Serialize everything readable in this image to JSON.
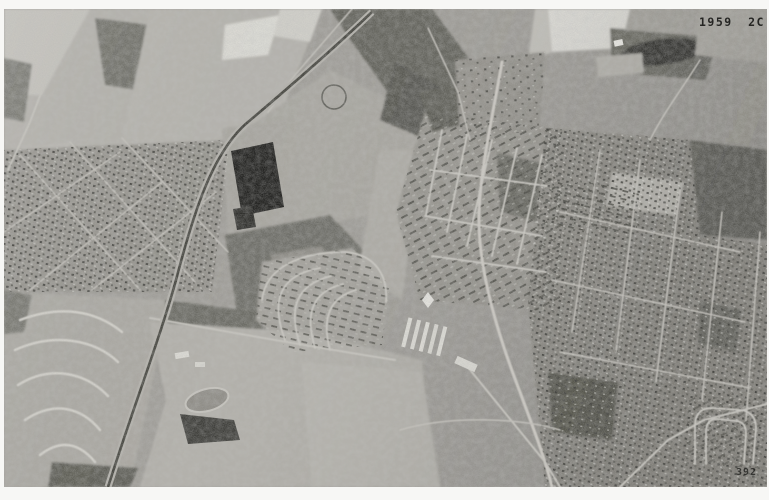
{
  "photo": {
    "alt": "Black-and-white 1959 aerial survey photograph of a suburban and rural landscape with fields, woods, a railroad, a large dark-roofed building, and curving residential subdivisions",
    "border_color": "#f7f7f5",
    "base_tone": "#a09e99",
    "field_light_tone": "#e3e2dd",
    "woods_dark_tone": "#60605a",
    "building_dark_tone": "#21211f",
    "stamp_color": "#1b1b19"
  },
  "stamps": {
    "photo_id": "1959 2C 392",
    "frame_number": "392"
  }
}
